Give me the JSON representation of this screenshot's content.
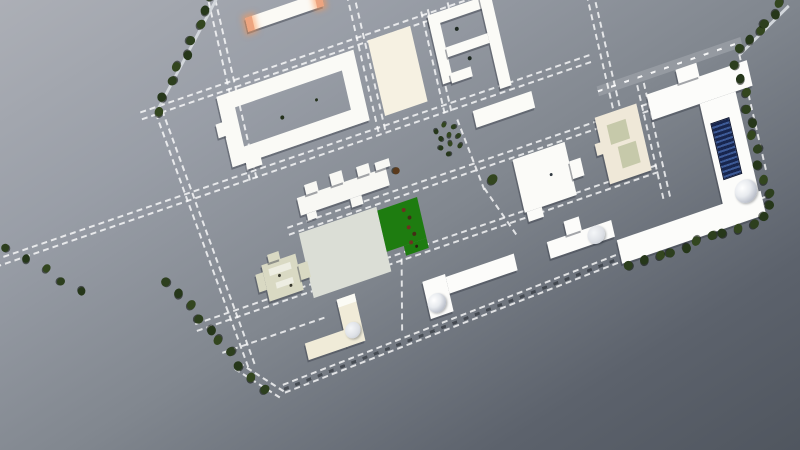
{
  "viewport": {
    "kind": "3d-site-plan-aerial-view",
    "background": {
      "from": "#acafb6",
      "mid": "#81878f",
      "to": "#50565f"
    },
    "transform": {
      "rotate_deg": -19,
      "skew_x_deg": -6
    }
  },
  "colors": {
    "building_white": "#fbfbf7",
    "building_cream": "#f0ebd8",
    "building_beige": "#efe8d8",
    "manor_olive": "#d9d9c3",
    "plaza_cream": "#f6f1e2",
    "plaza_gray": "#dbded6",
    "field_green": "#1e7c10",
    "orange_cap": "#eda47f",
    "solar_navy": "#18264e",
    "solar_stripe": "#3d5a96",
    "tree_green": "#2d3f1e",
    "road_dash": "rgba(255,255,255,0.78)",
    "shadow": "rgba(55,60,72,0.45)"
  },
  "buildings": [
    {
      "id": "north-bar-building",
      "parts": [
        {
          "x": 236,
          "y": 97,
          "w": 80,
          "h": 14,
          "c": "#fbfaf5"
        },
        {
          "x": 236,
          "y": 97,
          "w": 7,
          "h": 14,
          "c": "#eda47f",
          "glow": 1
        },
        {
          "x": 309,
          "y": 97,
          "w": 7,
          "h": 14,
          "c": "#eda47f",
          "glow": 1
        }
      ]
    },
    {
      "id": "courtyard-hall",
      "parts": [
        {
          "x": 190,
          "y": 162,
          "w": 145,
          "h": 72,
          "ring": 16,
          "c": "#fafaf6"
        },
        {
          "x": 204,
          "y": 232,
          "w": 16,
          "h": 9,
          "c": "#fafaf6"
        },
        {
          "x": 183,
          "y": 188,
          "w": 9,
          "h": 14,
          "c": "#fafaf6"
        }
      ]
    },
    {
      "id": "cream-plaza",
      "parts": [
        {
          "x": 351,
          "y": 158,
          "w": 45,
          "h": 77,
          "c": "#f6f1e2",
          "flat": 1
        }
      ]
    },
    {
      "id": "p-block-building",
      "parts": [
        {
          "x": 415,
          "y": 154,
          "w": 66,
          "h": 11,
          "c": "#fbfbf7"
        },
        {
          "x": 415,
          "y": 154,
          "w": 11,
          "h": 70,
          "c": "#fbfbf7"
        },
        {
          "x": 470,
          "y": 154,
          "w": 12,
          "h": 93,
          "c": "#fbfbf7"
        },
        {
          "x": 426,
          "y": 190,
          "w": 44,
          "h": 10,
          "c": "#fbfbf7"
        },
        {
          "x": 424,
          "y": 216,
          "w": 22,
          "h": 10,
          "c": "#fbfbf7"
        }
      ]
    },
    {
      "id": "east-bar-building",
      "parts": [
        {
          "x": 438,
          "y": 259,
          "w": 62,
          "h": 17,
          "c": "#fbfbf7"
        }
      ]
    },
    {
      "id": "stepped-building",
      "parts": [
        {
          "x": 246,
          "y": 284,
          "w": 94,
          "h": 18,
          "c": "#f8f8f4"
        },
        {
          "x": 256,
          "y": 274,
          "w": 13,
          "h": 10,
          "c": "#f8f8f4"
        },
        {
          "x": 283,
          "y": 272,
          "w": 13,
          "h": 12,
          "c": "#f8f8f4"
        },
        {
          "x": 311,
          "y": 274,
          "w": 13,
          "h": 10,
          "c": "#f8f8f4"
        },
        {
          "x": 330,
          "y": 276,
          "w": 15,
          "h": 8,
          "c": "#f8f8f4"
        },
        {
          "x": 252,
          "y": 302,
          "w": 10,
          "h": 7,
          "c": "#f8f8f4"
        },
        {
          "x": 298,
          "y": 302,
          "w": 12,
          "h": 9,
          "c": "#f8f8f4"
        }
      ]
    },
    {
      "id": "central-plaza",
      "parts": [
        {
          "x": 240,
          "y": 318,
          "w": 82,
          "h": 66,
          "c": "#dbded6",
          "flat": 1
        }
      ]
    },
    {
      "id": "green-field",
      "parts": [
        {
          "x": 322,
          "y": 322,
          "w": 42,
          "h": 42,
          "c": "#1e7c10",
          "flat": 1
        },
        {
          "x": 340,
          "y": 364,
          "w": 24,
          "h": 10,
          "c": "#1e7c10",
          "flat": 1
        }
      ]
    },
    {
      "id": "manor-house",
      "parts": [
        {
          "x": 196,
          "y": 336,
          "w": 36,
          "h": 37,
          "c": "#d9d9c3"
        },
        {
          "x": 188,
          "y": 343,
          "w": 8,
          "h": 18,
          "c": "#d9d9c3"
        },
        {
          "x": 232,
          "y": 347,
          "w": 10,
          "h": 16,
          "c": "#d9d9c3"
        },
        {
          "x": 204,
          "y": 328,
          "w": 12,
          "h": 8,
          "c": "#d9d9c3"
        },
        {
          "x": 202,
          "y": 342,
          "w": 23,
          "h": 7,
          "c": "#edede2",
          "flat": 1
        },
        {
          "x": 206,
          "y": 357,
          "w": 18,
          "h": 6,
          "c": "#edede2",
          "flat": 1
        }
      ]
    },
    {
      "id": "l-building-west",
      "parts": [
        {
          "x": 262,
          "y": 393,
          "w": 19,
          "h": 48,
          "c": "#f0ebd8"
        },
        {
          "x": 221,
          "y": 424,
          "w": 42,
          "h": 17,
          "c": "#f0ebd8"
        },
        {
          "x": 262,
          "y": 393,
          "w": 19,
          "h": 8,
          "c": "#fbfbf5",
          "flat": 1
        },
        {
          "shape": "circle",
          "x": 263,
          "y": 419,
          "d": 16,
          "grad": "cyl"
        }
      ]
    },
    {
      "id": "l-building-dome",
      "parts": [
        {
          "x": 374,
          "y": 407,
          "w": 72,
          "h": 17,
          "c": "#fcfcfa"
        },
        {
          "x": 350,
          "y": 404,
          "w": 24,
          "h": 38,
          "c": "#fcfcfa"
        },
        {
          "shape": "circle",
          "x": 350,
          "y": 419,
          "d": 19,
          "grad": "dome"
        }
      ]
    },
    {
      "id": "lab-building",
      "parts": [
        {
          "x": 481,
          "y": 407,
          "w": 68,
          "h": 17,
          "c": "#fcfcfa"
        },
        {
          "x": 502,
          "y": 393,
          "w": 16,
          "h": 14,
          "c": "#fcfcfa"
        },
        {
          "shape": "circle",
          "x": 522,
          "y": 407,
          "d": 18,
          "grad": "cyl"
        }
      ]
    },
    {
      "id": "central-building",
      "parts": [
        {
          "x": 466,
          "y": 318,
          "w": 55,
          "h": 54,
          "c": "#fbfbf8"
        },
        {
          "x": 521,
          "y": 338,
          "w": 12,
          "h": 18,
          "c": "#fbfbf8"
        },
        {
          "x": 468,
          "y": 372,
          "w": 16,
          "h": 10,
          "c": "#fbfbf8"
        }
      ]
    },
    {
      "id": "beige-court-building",
      "parts": [
        {
          "x": 556,
          "y": 305,
          "w": 44,
          "h": 68,
          "c": "#efe8d8"
        },
        {
          "x": 566,
          "y": 316,
          "w": 20,
          "h": 20,
          "c": "#c6c9aa",
          "flat": 1
        },
        {
          "x": 572,
          "y": 340,
          "w": 19,
          "h": 22,
          "c": "#c6c9aa",
          "flat": 1
        },
        {
          "x": 550,
          "y": 330,
          "w": 7,
          "h": 12,
          "c": "#efe8d8"
        }
      ]
    },
    {
      "id": "east-complex",
      "parts": [
        {
          "x": 612,
          "y": 300,
          "w": 106,
          "h": 26,
          "c": "#fcfcfa"
        },
        {
          "x": 646,
          "y": 286,
          "w": 22,
          "h": 14,
          "c": "#fcfcfa"
        },
        {
          "x": 662,
          "y": 326,
          "w": 38,
          "h": 104,
          "c": "#fcfcfa"
        },
        {
          "x": 668,
          "y": 348,
          "w": 20,
          "h": 58,
          "stripes": "solar"
        },
        {
          "x": 550,
          "y": 428,
          "w": 152,
          "h": 24,
          "c": "#fcfcfa"
        },
        {
          "shape": "circle",
          "x": 676,
          "y": 412,
          "d": 23,
          "grad": "dome"
        }
      ]
    }
  ],
  "roads": [
    {
      "id": "north-boundary-road",
      "t": "h",
      "x": 112,
      "y": 151,
      "len": 452
    },
    {
      "id": "second-avenue",
      "t": "h",
      "x": -85,
      "y": 243,
      "len": 650
    },
    {
      "id": "east-top-road",
      "t": "solid",
      "x": 565,
      "y": 276,
      "len": 152
    },
    {
      "id": "third-avenue",
      "t": "h",
      "x": 230,
      "y": 308,
      "len": 380
    },
    {
      "id": "fourth-avenue",
      "t": "h",
      "x": 118,
      "y": 369,
      "len": 488
    },
    {
      "id": "manor-lane",
      "t": "h",
      "x": 138,
      "y": 405,
      "len": 108,
      "single": 1
    },
    {
      "id": "south-boundary-road",
      "t": "boundary",
      "x": 190,
      "y": 455,
      "len": 516,
      "rot": -2.3
    },
    {
      "id": "west-boundary-road",
      "t": "v",
      "x": 126,
      "y": 158,
      "len": 272,
      "rot": -7
    },
    {
      "id": "southwest-corner-road",
      "t": "v",
      "x": 146,
      "y": 426,
      "len": 56,
      "rot": -42
    },
    {
      "id": "west-street",
      "t": "v",
      "x": 203,
      "y": 60,
      "len": 192
    },
    {
      "id": "plaza-street",
      "t": "v",
      "x": 340,
      "y": 108,
      "len": 140
    },
    {
      "id": "center-street",
      "t": "v",
      "x": 409,
      "y": 148,
      "len": 104
    },
    {
      "id": "center-street-curve-1",
      "t": "v",
      "x": 420,
      "y": 262,
      "len": 76,
      "rot": -8,
      "single": 1
    },
    {
      "id": "center-street-curve-2",
      "t": "v",
      "x": 431,
      "y": 336,
      "len": 58,
      "rot": -21,
      "single": 1
    },
    {
      "id": "north-spur-path",
      "t": "v",
      "x": 437,
      "y": 122,
      "len": 32,
      "single": 1
    },
    {
      "id": "east-street",
      "t": "v",
      "x": 575,
      "y": 186,
      "len": 126
    },
    {
      "id": "complex-street",
      "t": "v",
      "x": 604,
      "y": 288,
      "len": 116
    },
    {
      "id": "east-boundary-path",
      "t": "v",
      "x": 711,
      "y": 292,
      "len": 118,
      "single": 1
    },
    {
      "id": "south-field-street",
      "t": "v",
      "x": 334,
      "y": 375,
      "len": 70,
      "rot": 13,
      "single": 1
    },
    {
      "id": "northeast-access-road",
      "t": "line",
      "x": 712,
      "y": 291,
      "len": 66,
      "rot": -27
    },
    {
      "id": "northwest-edge-road",
      "t": "line",
      "x": 213,
      "y": 71,
      "len": 122,
      "rot": 134
    }
  ],
  "tree_rows": [
    {
      "id": "northwest-tree-row",
      "x1": 208,
      "y1": 66,
      "x2": 130,
      "y2": 156,
      "n": 9,
      "s": 9
    },
    {
      "id": "west-tree-row",
      "x1": 101,
      "y1": 322,
      "x2": 168,
      "y2": 452,
      "n": 10,
      "s": 9
    },
    {
      "id": "east-tree-column",
      "x1": 707,
      "y1": 302,
      "x2": 708,
      "y2": 446,
      "n": 11,
      "s": 9
    },
    {
      "id": "south-wing-tree-row",
      "x1": 558,
      "y1": 457,
      "x2": 700,
      "y2": 455,
      "n": 11,
      "s": 9
    },
    {
      "id": "northeast-tree-row",
      "x1": 716,
      "y1": 288,
      "x2": 764,
      "y2": 258,
      "n": 6,
      "s": 9
    },
    {
      "id": "far-west-tree-row",
      "x1": -48,
      "y1": 238,
      "x2": 12,
      "y2": 300,
      "n": 5,
      "s": 8
    }
  ],
  "trees": [
    {
      "x": 442,
      "y": 330,
      "s": 10
    },
    {
      "x": 349,
      "y": 290,
      "s": 7,
      "c": "#5a3a1c"
    },
    {
      "x": 397,
      "y": 266,
      "s": 5
    },
    {
      "x": 406,
      "y": 262,
      "s": 5
    },
    {
      "x": 415,
      "y": 267,
      "s": 5
    },
    {
      "x": 400,
      "y": 274,
      "s": 5
    },
    {
      "x": 409,
      "y": 273,
      "s": 5
    },
    {
      "x": 418,
      "y": 277,
      "s": 5
    },
    {
      "x": 398,
      "y": 283,
      "s": 5
    },
    {
      "x": 408,
      "y": 282,
      "s": 5
    },
    {
      "x": 417,
      "y": 287,
      "s": 5
    },
    {
      "x": 404,
      "y": 291,
      "s": 5
    }
  ],
  "dots": [
    {
      "x": 250,
      "y": 203,
      "s": 4,
      "c": "#23301a"
    },
    {
      "x": 287,
      "y": 197,
      "s": 3,
      "c": "#23301a"
    },
    {
      "x": 441,
      "y": 176,
      "s": 4,
      "c": "#1d2820"
    },
    {
      "x": 447,
      "y": 208,
      "s": 4,
      "c": "#1d2820"
    },
    {
      "x": 211,
      "y": 351,
      "s": 3,
      "c": "#3a3a30"
    },
    {
      "x": 220,
      "y": 364,
      "s": 3,
      "c": "#3a3a30"
    },
    {
      "x": 500,
      "y": 344,
      "s": 3,
      "c": "#333c44"
    },
    {
      "x": 348,
      "y": 330,
      "s": 4,
      "c": "#6d3220"
    },
    {
      "x": 352,
      "y": 339,
      "s": 4,
      "c": "#432d16"
    },
    {
      "x": 349,
      "y": 348,
      "s": 4,
      "c": "#6d3220"
    },
    {
      "x": 353,
      "y": 356,
      "s": 4,
      "c": "#432d16"
    },
    {
      "x": 348,
      "y": 363,
      "s": 4,
      "c": "#6d3220"
    },
    {
      "x": 352,
      "y": 368,
      "s": 3,
      "c": "#2c1f10"
    }
  ]
}
